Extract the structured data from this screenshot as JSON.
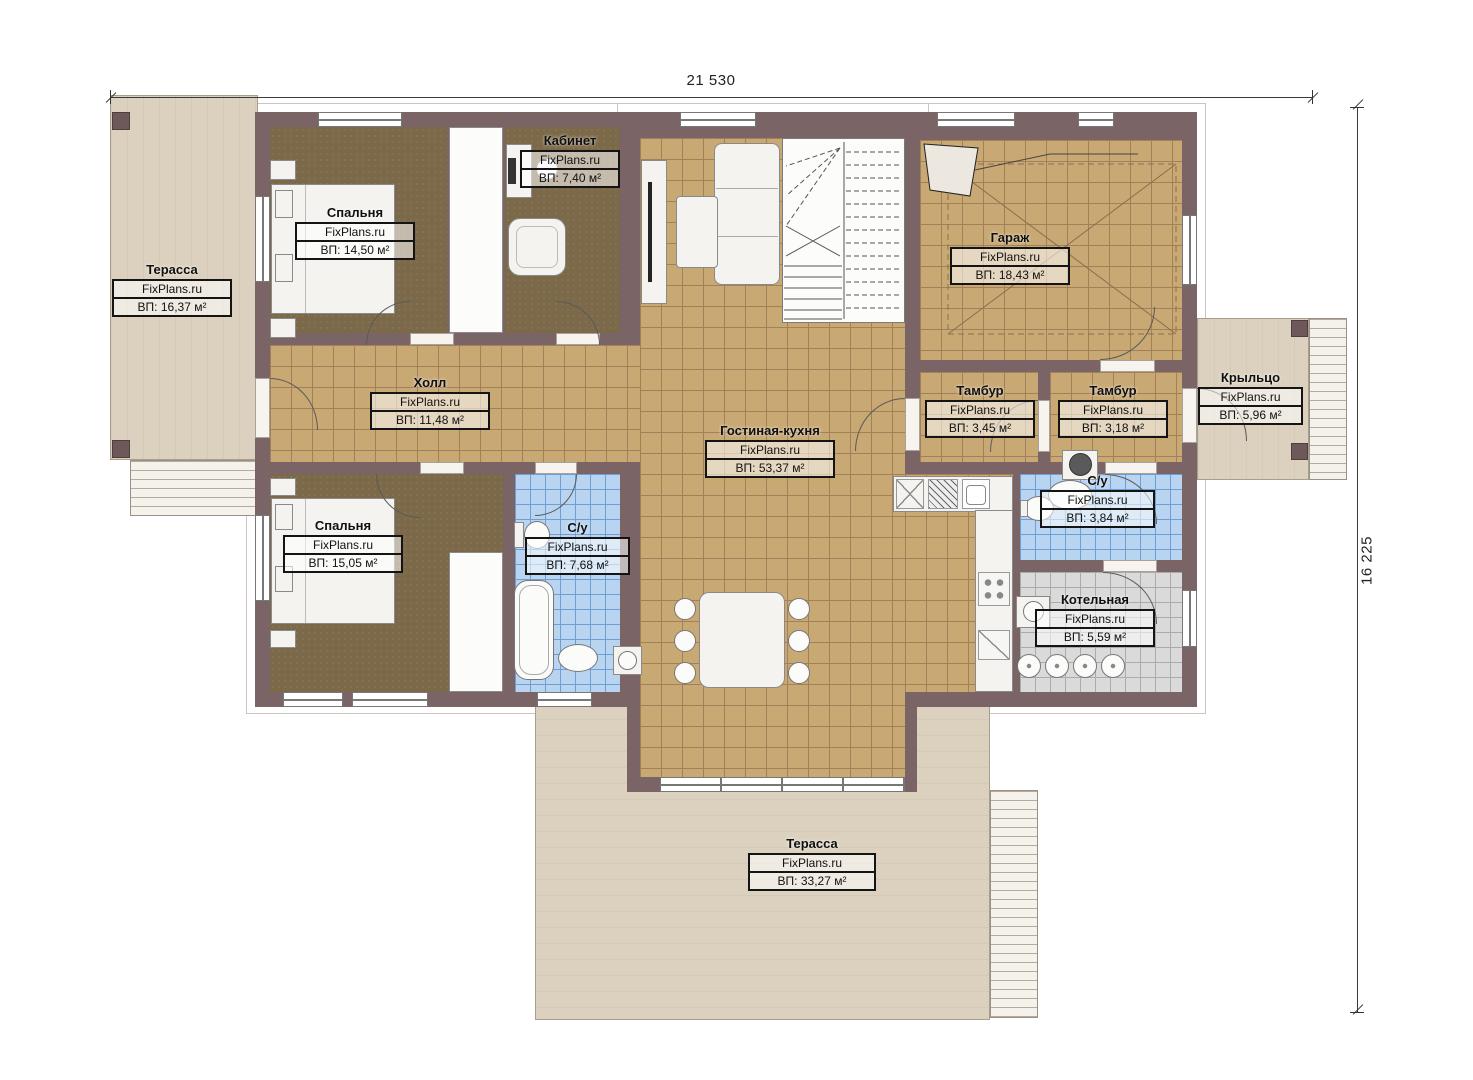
{
  "plan": {
    "watermark": "FixPlans.ru",
    "dimensions": {
      "width": "21 530",
      "height": "16 225"
    },
    "rooms": {
      "terrace_left": {
        "name": "Терасса",
        "area": "ВП: 16,37 м²"
      },
      "bedroom_top": {
        "name": "Спальня",
        "area": "ВП: 14,50 м²"
      },
      "office": {
        "name": "Кабинет",
        "area": "ВП: 7,40 м²"
      },
      "garage": {
        "name": "Гараж",
        "area": "ВП: 18,43 м²"
      },
      "hall": {
        "name": "Холл",
        "area": "ВП: 11,48 м²"
      },
      "living_kitchen": {
        "name": "Гостиная-кухня",
        "area": "ВП: 53,37 м²"
      },
      "tambour_left": {
        "name": "Тамбур",
        "area": "ВП: 3,45 м²"
      },
      "tambour_right": {
        "name": "Тамбур",
        "area": "ВП: 3,18 м²"
      },
      "porch": {
        "name": "Крыльцо",
        "area": "ВП: 5,96 м²"
      },
      "bedroom_bottom": {
        "name": "Спальня",
        "area": "ВП: 15,05 м²"
      },
      "bathroom_main": {
        "name": "С/у",
        "area": "ВП: 7,68 м²"
      },
      "bathroom_small": {
        "name": "С/у",
        "area": "ВП: 3,84 м²"
      },
      "boiler": {
        "name": "Котельная",
        "area": "ВП: 5,59 м²"
      },
      "terrace_bottom": {
        "name": "Терасса",
        "area": "ВП: 33,27 м²"
      }
    },
    "colors": {
      "wall": "#7b6466",
      "tile": "#c8a873",
      "tile_line": "#a3805a",
      "carpet": "#7c6949",
      "blue": "#b9d4f0",
      "blue_line": "#6f9fd2",
      "gray": "#dadada",
      "gray_line": "#ababab",
      "terrace": "#dcd1bf"
    }
  }
}
